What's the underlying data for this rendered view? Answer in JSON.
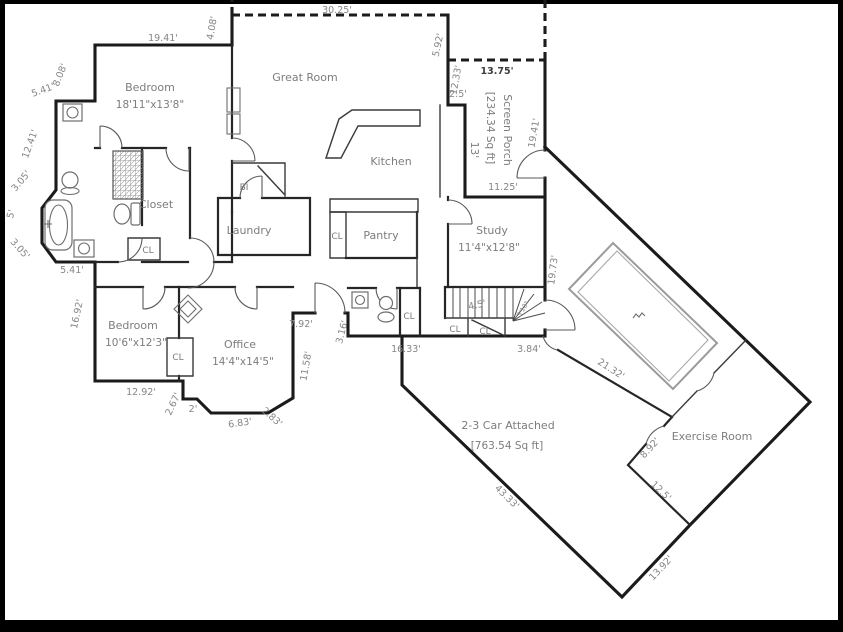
{
  "plan": {
    "rooms": {
      "bedroom_master": {
        "name": "Bedroom",
        "size": "18'11\"x13'8\""
      },
      "great_room": {
        "name": "Great Room"
      },
      "kitchen": {
        "name": "Kitchen"
      },
      "closet_master": {
        "name": "Closet"
      },
      "laundry": {
        "name": "Laundry"
      },
      "built_in": {
        "name": "BI"
      },
      "pantry": {
        "name": "Pantry"
      },
      "screen_porch": {
        "name": "Screen Porch",
        "area": "[234.34 Sq ft]",
        "width": "13'"
      },
      "study": {
        "name": "Study",
        "size": "11'4\"x12'8\""
      },
      "bedroom2": {
        "name": "Bedroom",
        "size": "10'6\"x12'3\""
      },
      "office": {
        "name": "Office",
        "size": "14'4\"x14'5\""
      },
      "garage": {
        "name": "2-3 Car Attached",
        "area": "[763.54 Sq ft]"
      },
      "exercise_room": {
        "name": "Exercise Room"
      }
    },
    "closet_abbrev": "CL",
    "dims": {
      "bedroom_top": "19.41'",
      "great_room_offset": "4.08'",
      "great_room_top": "30.25'",
      "porch_step_right": "5.92'",
      "porch_left_upper": "12.33'",
      "porch_top": "13.75'",
      "porch_jog": "2.5'",
      "porch_right": "19.41'",
      "porch_bottom": "11.25'",
      "study_right": "19.73'",
      "bed_left_upper": "8.08'",
      "bath_top": "5.41'",
      "bath_left": "12.41'",
      "bay_upper": "3.05'",
      "bay_left": "5'",
      "bay_lower": "3.05'",
      "bath_bottom": "5.41'",
      "bed2_left": "16.92'",
      "bed2_bottom": "12.92'",
      "office_bay_a": "2.67'",
      "office_bay_b": "2'",
      "office_bay_c": "6.83'",
      "office_bay_d": "2.83'",
      "office_right": "11.58'",
      "entry_top": "7.92'",
      "entry_side": "3.16'",
      "hall_bottom": "16.33'",
      "stair_bottom": "3.84'",
      "stair_run": "4.5'",
      "stair_winder": "3'10\"",
      "garage_upper": "21.32'",
      "garage_left": "43.33'",
      "exercise_door_wall": "8.92'",
      "exercise_left": "12.5'",
      "garage_bottom": "13.92'"
    }
  }
}
